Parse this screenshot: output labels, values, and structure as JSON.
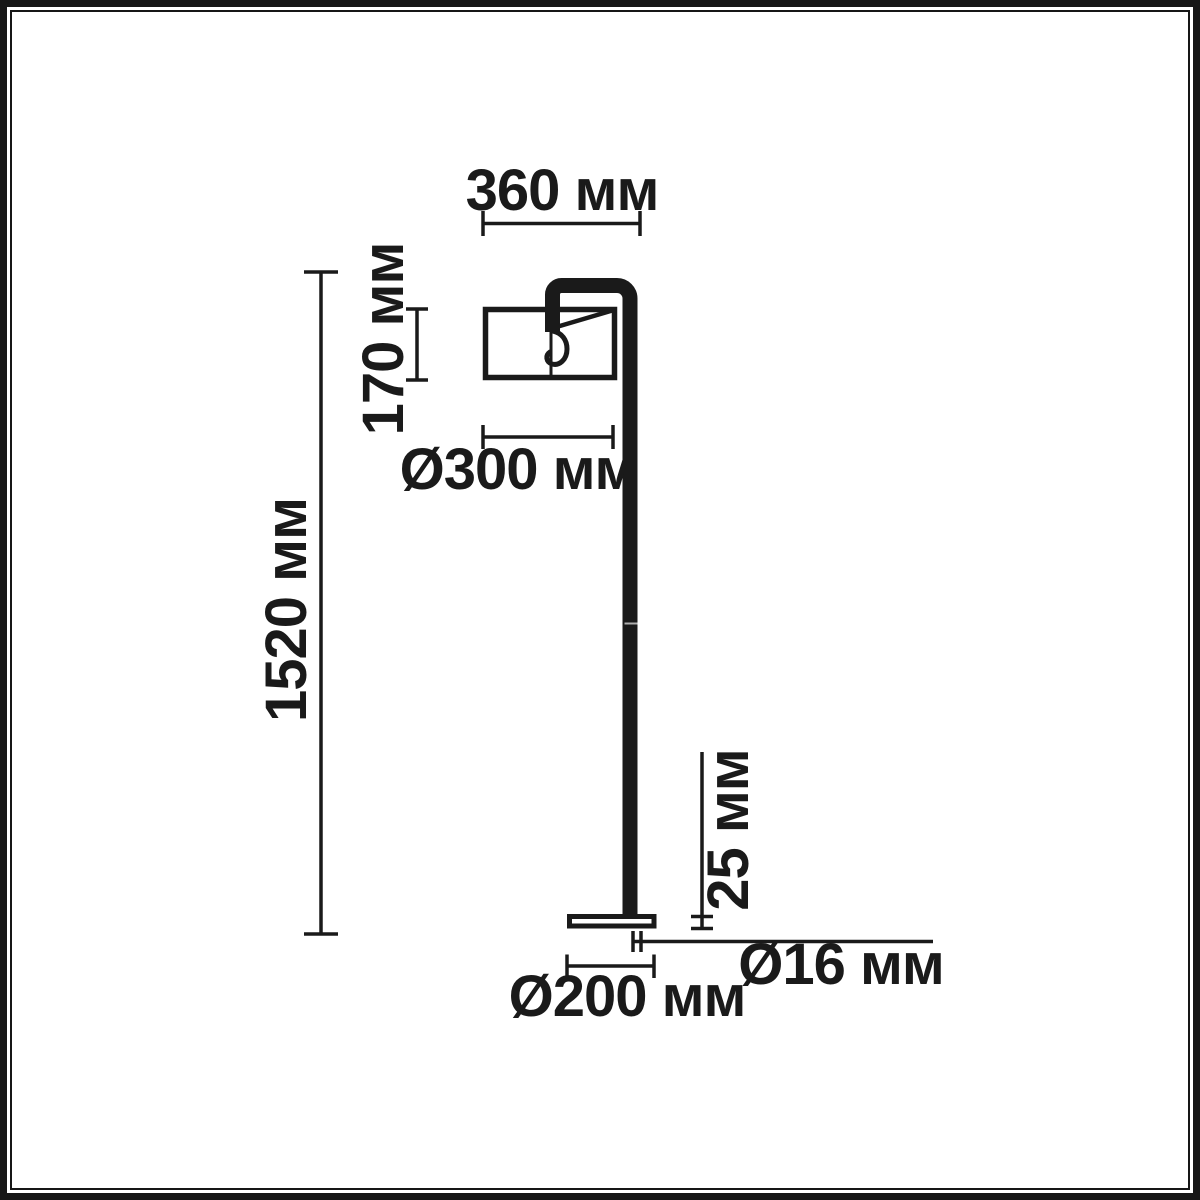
{
  "diagram": {
    "labels": {
      "shade_width": "360 мм",
      "shade_height": "170 мм",
      "shade_diameter": "Ø300 мм",
      "total_height": "1520 мм",
      "base_height": "25 мм",
      "pole_diameter": "Ø16 мм",
      "base_diameter": "Ø200 мм"
    },
    "colors": {
      "ink": "#1a1a1a",
      "background": "#ffffff"
    }
  }
}
